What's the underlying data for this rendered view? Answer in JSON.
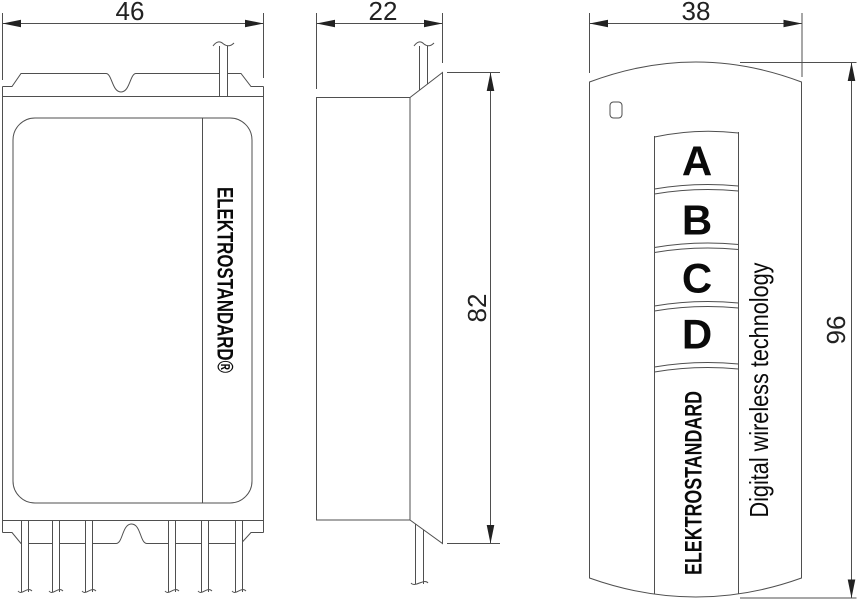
{
  "drawing": {
    "type": "technical dimensional drawing, three views of a wireless control set (receiver box and remote control)",
    "views": {
      "receiver_front": {
        "name": "receiver front view",
        "width_label": "46",
        "brand": "ELEKTROSTANDARD®"
      },
      "receiver_side": {
        "name": "receiver side view",
        "width_label": "22",
        "height_label": "82"
      },
      "remote": {
        "name": "remote control front view",
        "width_label": "38",
        "height_label": "96",
        "buttons": [
          "A",
          "B",
          "C",
          "D"
        ],
        "brand": "ELEKTROSTANDARD",
        "tagline": "Digital wireless technology"
      }
    },
    "colors": {
      "line": "#4f4f4f",
      "dim": "#222222",
      "label": "#0a0a0a",
      "background": "#ffffff"
    }
  }
}
